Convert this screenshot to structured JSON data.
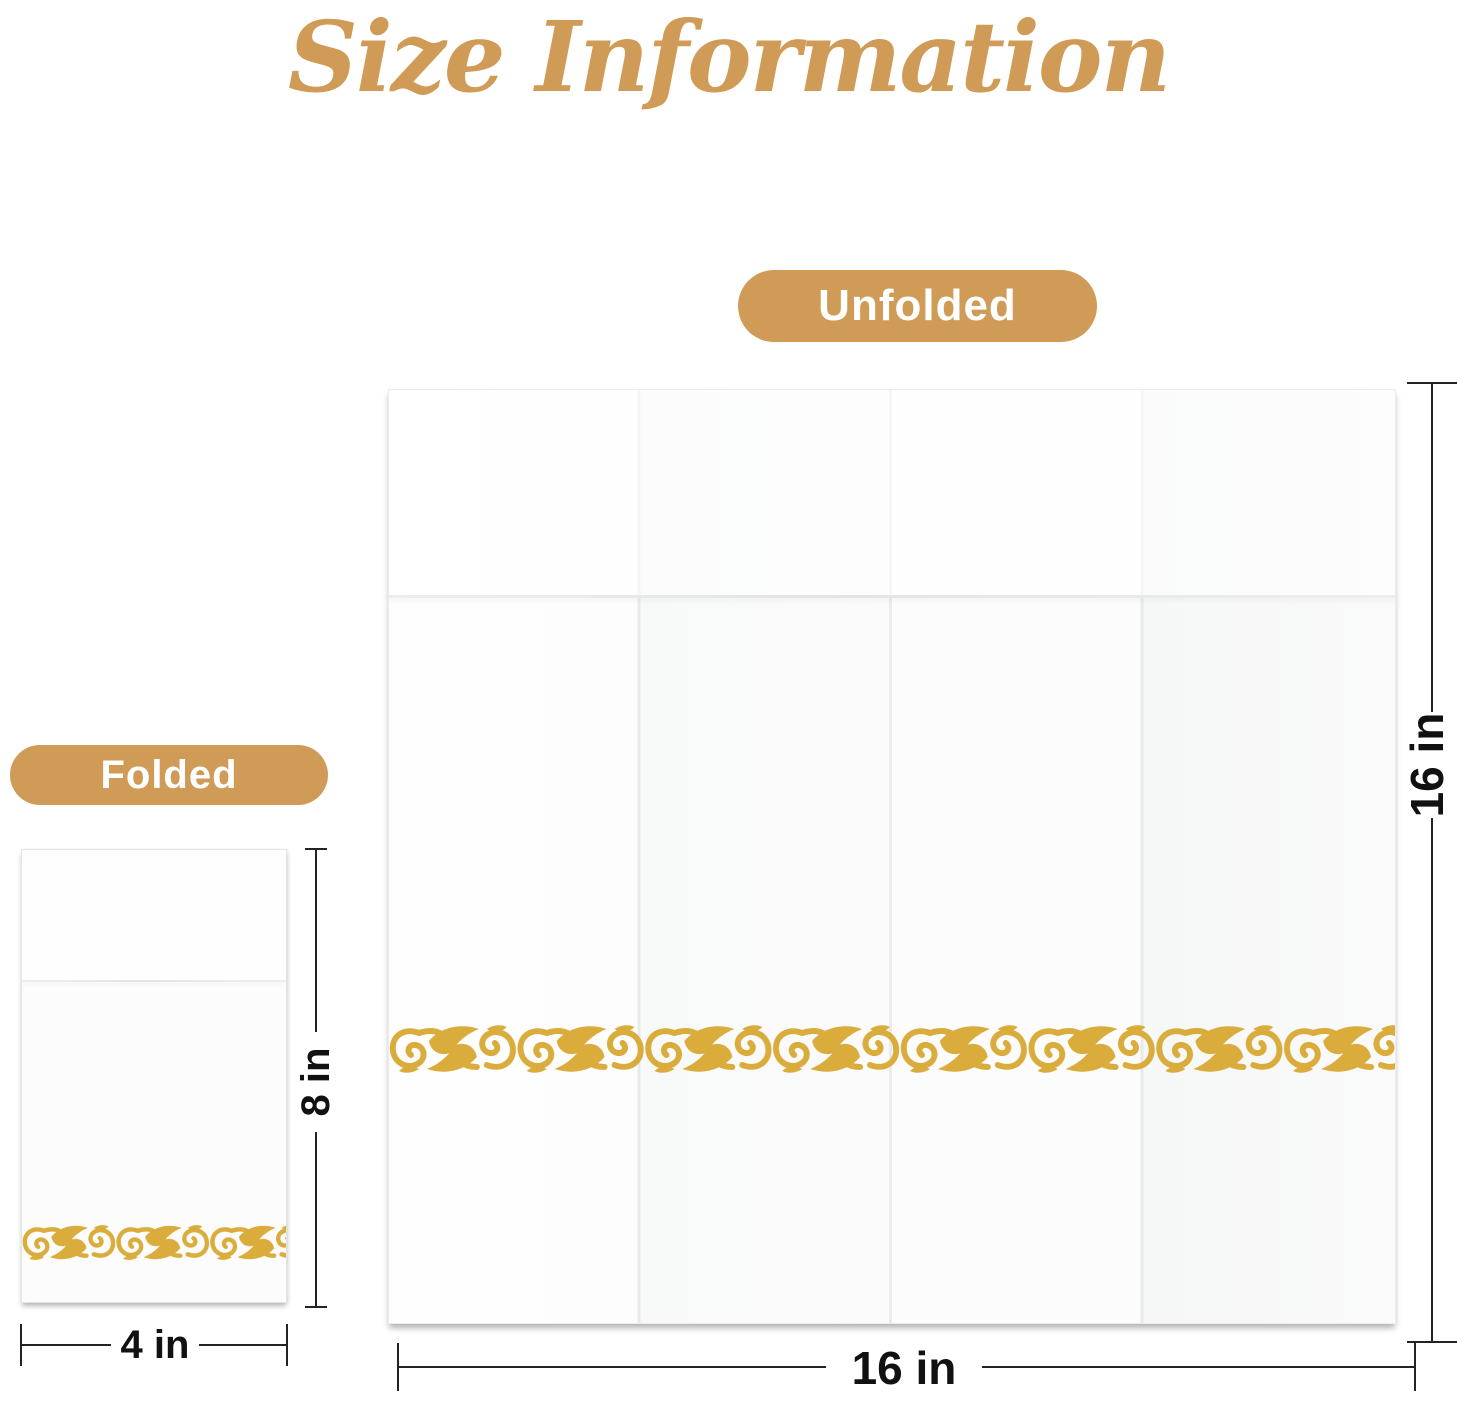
{
  "page": {
    "title": "Size Information"
  },
  "colors": {
    "accent": "#CF9B57",
    "ornament_gold": "#D9AC3C",
    "dimension_line": "#232323",
    "dimension_text": "#111111",
    "badge_text": "#FFFFFF",
    "napkin_white": "#FDFDFD"
  },
  "unfolded_panel": {
    "badge": "Unfolded",
    "height_label": "16 in",
    "width_label": "16 in"
  },
  "folded_panel": {
    "badge": "Folded",
    "height_label": "8 in",
    "width_label": "4 in"
  },
  "icons": {
    "ornament": "gold-scroll-border"
  }
}
